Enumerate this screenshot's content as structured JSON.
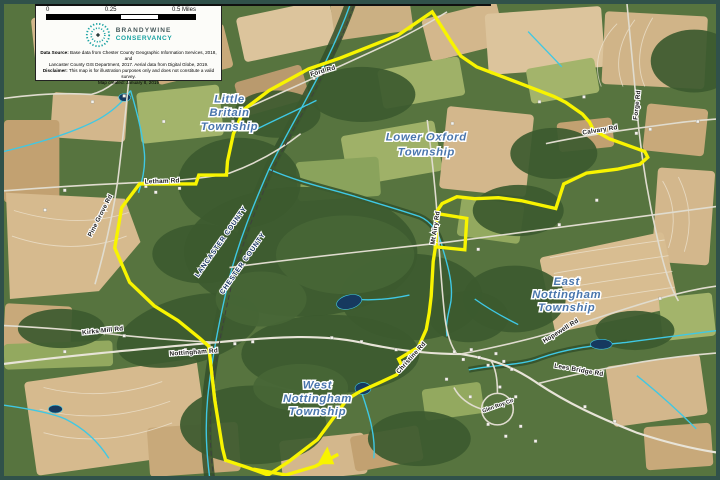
{
  "legend": {
    "scale": {
      "t0": "0",
      "t1": "0.25",
      "t2": "0.5 Miles"
    },
    "logo": {
      "name1": "BRANDYWINE",
      "name2": "CONSERVANCY"
    },
    "credits": {
      "src_label": "Data Source:",
      "src1": " Base data from Chester County Geographic Information Services, 2018, and",
      "src2": "Lancaster County GIS Department, 2017. Aerial data from Digital Globe, 2019.",
      "disc_label": "Disclaimer:",
      "disc1": " This map is for illustration purposes only and does not constitute a valid survey.",
      "created": "Map created: January 8, 2019"
    }
  },
  "map": {
    "townships": {
      "little_britain": {
        "l1": "Little",
        "l2": "Britain",
        "l3": "Township"
      },
      "lower_oxford": {
        "l1": "Lower Oxford",
        "l2": "Township"
      },
      "east_nottingham": {
        "l1": "East",
        "l2": "Nottingham",
        "l3": "Township"
      },
      "west_nottingham": {
        "l1": "West",
        "l2": "Nottingham",
        "l3": "Township"
      }
    },
    "counties": {
      "lancaster": "LANCASTER COUNTY",
      "chester": "CHESTER COUNTY"
    },
    "roads": {
      "ford": "Ford Rd",
      "letham": "Letham Rd",
      "pine_grove": "Pine Grove Rd",
      "mt_airy": "Mt Airy Rd",
      "calvary": "Calvary Rd",
      "forge": "Forge Rd",
      "kirks_mill": "Kirks Mill Rd",
      "nottingham": "Nottingham Rd",
      "christine": "Christine Rd",
      "hopewell": "Hopewell Rd",
      "lees_bridge": "Lees Bridge Rd",
      "glen_roy": "Glen Roy Cir"
    },
    "colors": {
      "boundary": "#F8F400",
      "stream": "#3FC8E4",
      "township_label": "#4A76AD"
    }
  }
}
